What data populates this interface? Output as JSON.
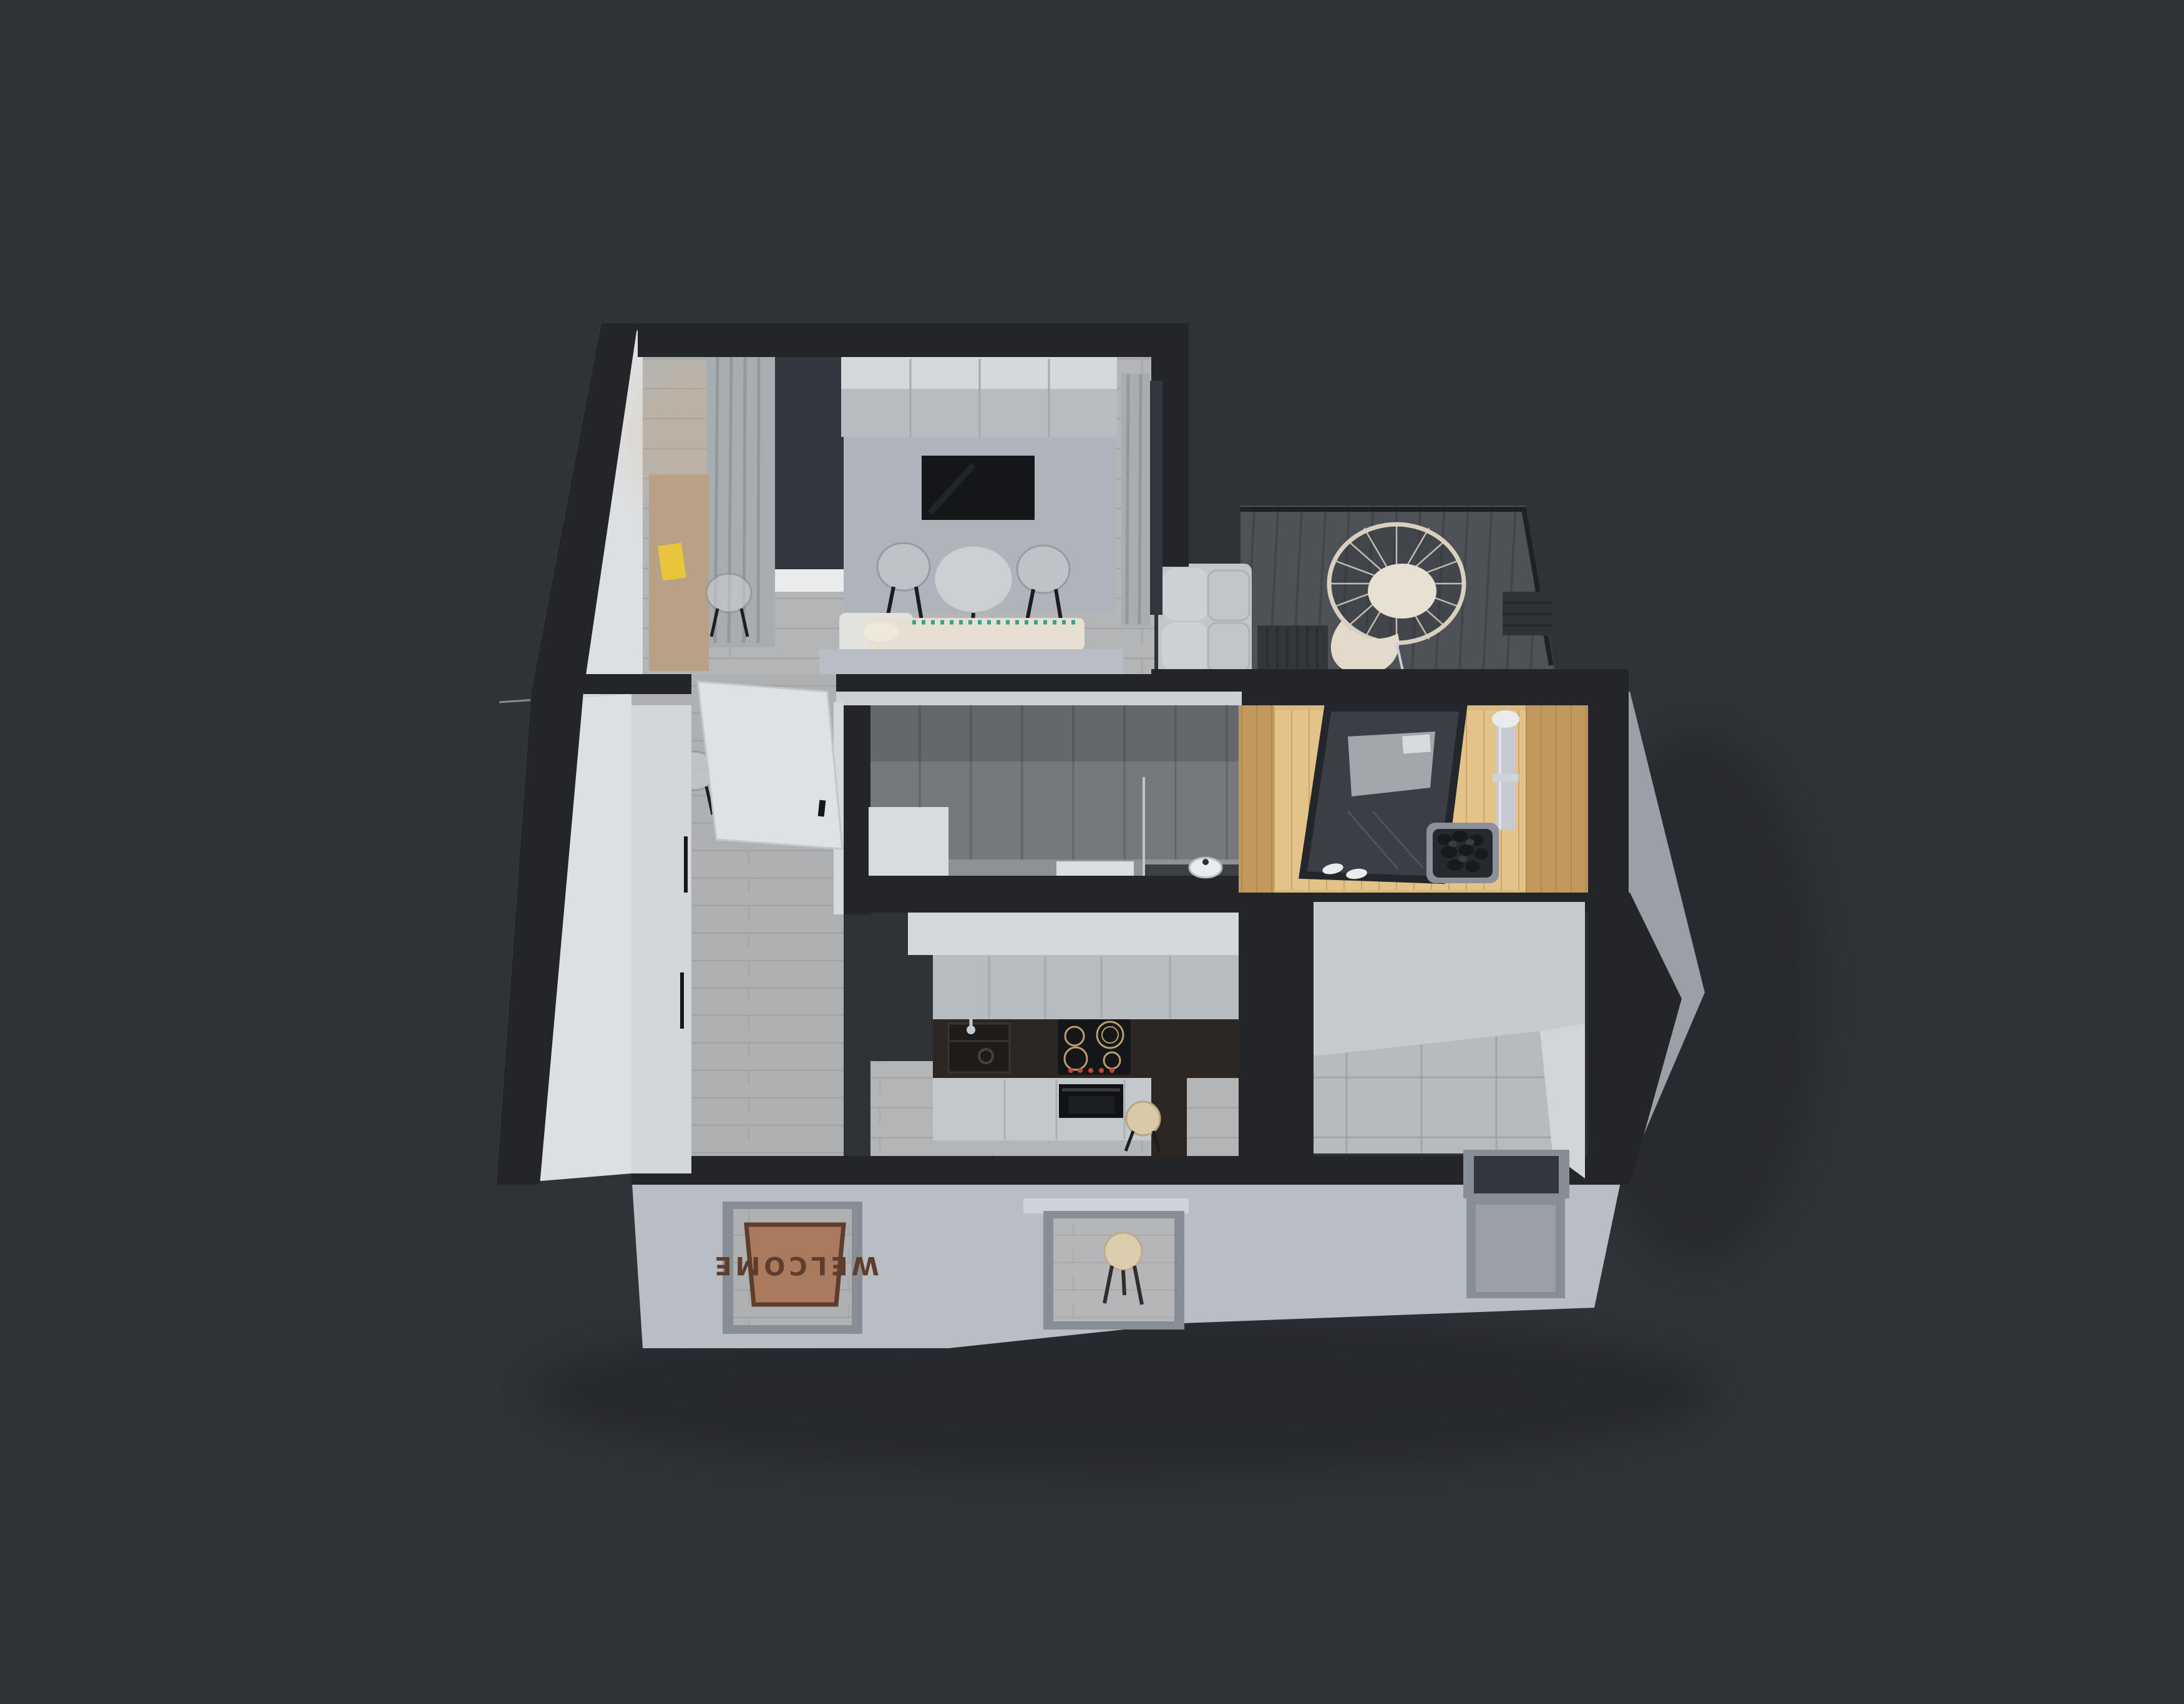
{
  "doormat": {
    "text": "WELCOME"
  },
  "palette": {
    "bg": "#2f3237",
    "wallCut": "#232529",
    "faceBright": "#dde0e3",
    "faceMid": "#b9bec4",
    "faceDim": "#9aa0a6",
    "floorWood": "#b3b5b6",
    "hallWood": "#aeb0b2",
    "plankLine": "#9d9fa1",
    "deck": "#4e5257",
    "deckLine": "#42464b",
    "saunaWood": "#d9b97e",
    "saunaWoodDark": "#c2995c",
    "saunaFloor": "#e3c389",
    "concrete": "#75797e",
    "concreteDark": "#5f6367",
    "concreteFloor": "#8e9296",
    "tileFloor": "#b7bbbf",
    "tileLine": "#9aa0a6",
    "cabinetTop": "#d6d9dc",
    "cabinetFront": "#b7bcc1",
    "counterDark": "#2c2723",
    "black": "#141619",
    "panelGray": "#aeb4ba",
    "white": "#e9ebed",
    "bedCream": "#e7dfd2",
    "rugWhite": "#e2e2de",
    "teal": "#2fa39a",
    "sofa": "#c2c6c9",
    "sofaLight": "#cdd1d4",
    "matBrown": "#a97a5e",
    "matDark": "#5f3d2c",
    "stool": "#d9c9a8",
    "glass": "#3b3f45",
    "glassDark": "#33373d",
    "curtain": "#a8adb2",
    "curtainDark": "#8e9398",
    "yellow": "#e9c53b",
    "steel": "#c6cbd1",
    "deskWood": "#b7a288",
    "frameGray": "#878e95",
    "doorWhite": "#dfe2e5",
    "railing": "#1b1d20",
    "wire": "#d9d0c2"
  }
}
